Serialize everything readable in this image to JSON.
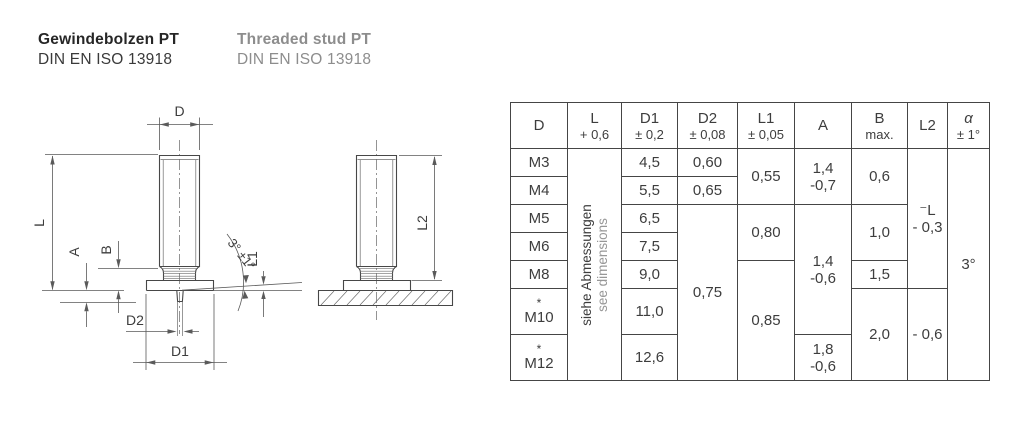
{
  "header": {
    "title_de": "Gewindebolzen PT",
    "standard_de": "DIN EN ISO 13918",
    "title_en": "Threaded stud PT",
    "standard_en": "DIN EN ISO 13918"
  },
  "drawing": {
    "front_view": {
      "dim_d": "D",
      "dim_l": "L",
      "dim_a": "A",
      "dim_b": "B",
      "dim_d2": "D2",
      "dim_d1": "D1",
      "dim_l1": "L1",
      "angle": "3° ±1°"
    },
    "side_view": {
      "dim_l2": "L2"
    }
  },
  "table": {
    "columns": [
      {
        "name": "D",
        "tol": ""
      },
      {
        "name": "L",
        "tol": "+ 0,6"
      },
      {
        "name": "D1",
        "tol": "± 0,2"
      },
      {
        "name": "D2",
        "tol": "± 0,08"
      },
      {
        "name": "L1",
        "tol": "± 0,05"
      },
      {
        "name": "A",
        "tol": ""
      },
      {
        "name": "B",
        "tol": "max."
      },
      {
        "name": "L2",
        "tol": ""
      },
      {
        "name": "α",
        "tol": "± 1°"
      }
    ],
    "size_note": {
      "de": "siehe Abmessungen",
      "en": "see dimensions"
    },
    "rows": {
      "m3": {
        "star": "",
        "d": "M3",
        "d1": "4,5"
      },
      "m4": {
        "star": "",
        "d": "M4",
        "d1": "5,5"
      },
      "m5": {
        "star": "",
        "d": "M5",
        "d1": "6,5"
      },
      "m6": {
        "star": "",
        "d": "M6",
        "d1": "7,5"
      },
      "m8": {
        "star": "",
        "d": "M8",
        "d1": "9,0"
      },
      "m10": {
        "star": "*",
        "d": "M10",
        "d1": "11,0"
      },
      "m12": {
        "star": "*",
        "d": "M12",
        "d1": "12,6"
      }
    },
    "d2": {
      "m3": "0,60",
      "m4": "0,65",
      "m5_m12": "0,75"
    },
    "l1": {
      "m3_m4": "0,55",
      "m5_m6": "0,80",
      "m8_m12": "0,85"
    },
    "a": {
      "m3_m4": [
        "1,4",
        "-0,7"
      ],
      "m5_m10": [
        "1,4",
        "-0,6"
      ],
      "m12": [
        "1,8",
        "-0,6"
      ]
    },
    "b": {
      "m3_m4": "0,6",
      "m5_m6": "1,0",
      "m8": "1,5",
      "m10_m12": "2,0"
    },
    "l2": {
      "m3_m8": [
        "⁻L",
        "- 0,3"
      ],
      "m10_m12": "- 0,6"
    },
    "alpha": {
      "all": "3°"
    }
  }
}
